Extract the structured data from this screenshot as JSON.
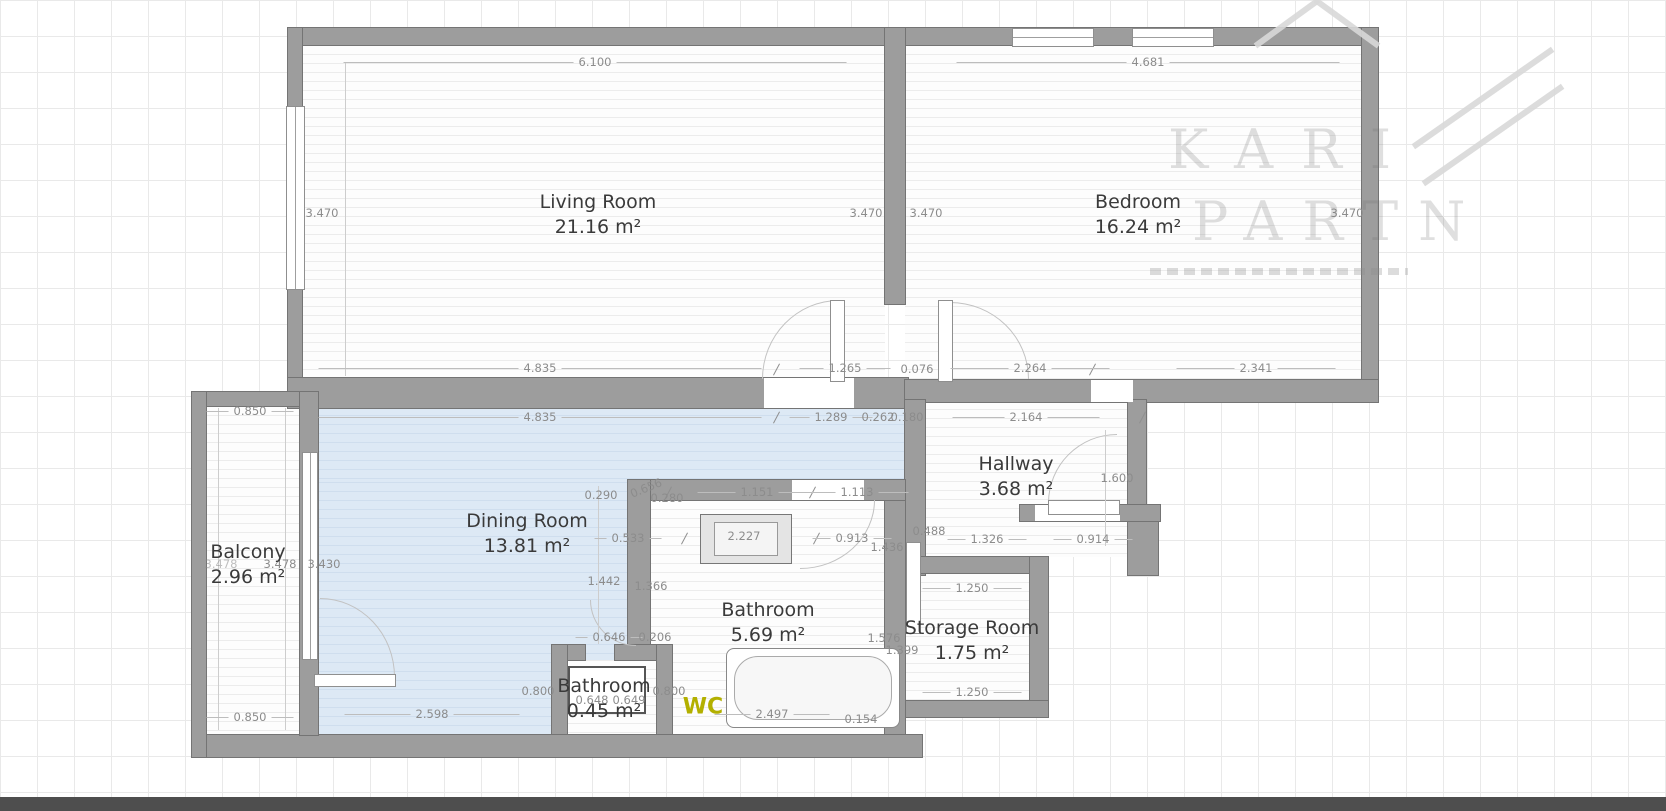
{
  "watermark": {
    "line1": "KARI",
    "line2": "PARTN"
  },
  "rooms": {
    "living": {
      "name": "Living Room",
      "area": "21.16 m²"
    },
    "bedroom": {
      "name": "Bedroom",
      "area": "16.24 m²"
    },
    "dining": {
      "name": "Dining Room",
      "area": "13.81 m²"
    },
    "hallway": {
      "name": "Hallway",
      "area": "3.68 m²"
    },
    "bathroom": {
      "name": "Bathroom",
      "area": "5.69 m²"
    },
    "bathroom_small": {
      "name": "Bathroom",
      "area": "0.45 m²"
    },
    "storage": {
      "name": "Storage Room",
      "area": "1.75 m²"
    },
    "balcony": {
      "name": "Balcony",
      "area": "2.96 m²"
    },
    "wc": "WC"
  },
  "dims": {
    "living_top": "6.100",
    "bedroom_top": "4.681",
    "living_left": "3.470",
    "living_right": "3.470",
    "bedroom_left": "3.470",
    "bedroom_right": "3.470",
    "living_bottom": "4.835",
    "living_door": "1.265",
    "bedroom_offset": "0.076",
    "bedroom_bottom_left": "2.264",
    "bedroom_bottom_right": "2.341",
    "dining_top": "4.835",
    "dining_door": "1.289",
    "hall_niche_a": "0.262",
    "hall_niche_b": "0.180",
    "hallway_top": "2.164",
    "hallway_right": "1.600",
    "hallway_a": "0.488",
    "hallway_b": "1.326",
    "hallway_c": "0.914",
    "bath_niche_a": "0.290",
    "bath_niche_b": "0.656",
    "bath_niche_c": "0.280",
    "bath_top_a": "1.151",
    "bath_top_b": "1.113",
    "bath_mid_a": "0.533",
    "vanity_width": "2.227",
    "bath_mid_b": "0.913",
    "bath_mid_c": "1.436",
    "bath_left_a": "1.442",
    "bath_left_b": "1.366",
    "bath_low_a": "0.646",
    "bath_low_b": "0.206",
    "bath_right_a": "1.576",
    "bath_right_b": "1.399",
    "storage_top": "1.250",
    "storage_bottom": "1.250",
    "balcony_top": "0.850",
    "balcony_height_a": "3.478",
    "balcony_height_b": "3.478",
    "dining_left": "3.430",
    "balcony_bottom": "0.850",
    "dining_bottom": "2.598",
    "smallbath_left": "0.800",
    "smallbath_a": "0.648",
    "smallbath_b": "0.649",
    "smallbath_right": "0.800",
    "tub_width": "2.497",
    "tub_edge": "0.154"
  },
  "colors": {
    "dining_fill": "#dde9f5",
    "wall": "#9d9d9d",
    "wc_text": "#b3b000",
    "bottom_bar": "#4e4e4e"
  }
}
